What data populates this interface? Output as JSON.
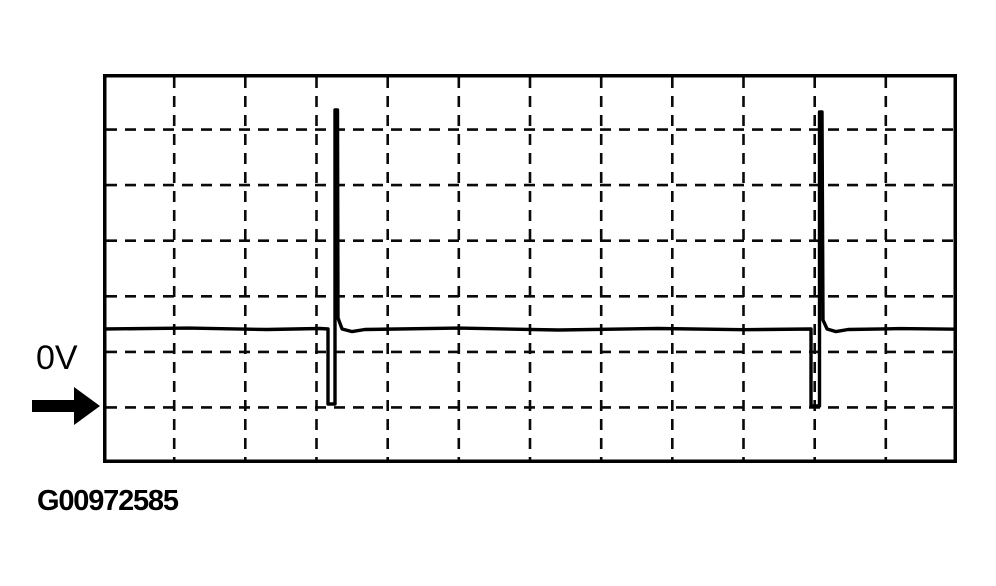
{
  "colors": {
    "background": "#ffffff",
    "trace": "#000000",
    "grid": "#0a0a0a",
    "border": "#000000",
    "text": "#000000"
  },
  "scope": {
    "zero_volt_label": "0V",
    "arrow_icon": "right-arrow pointing to 0V reference gridline"
  },
  "caption": {
    "figure_id": "G00972585"
  },
  "chart_data": {
    "type": "line",
    "title": "",
    "xlabel": "",
    "ylabel": "",
    "description": "Oscilloscope voltage waveform (scan-style figure). Flat baseline sits about 1.4 divisions above the 0V reference line. Two narrow dips drop to 0V (pulse on-time), each immediately followed by a tall narrow voltage spike reaching about 5.3 divisions above 0V, then the trace settles back to the baseline.",
    "grid": "dashed",
    "legend": "none",
    "x_divisions": 12,
    "y_divisions": 7,
    "zero_volt_line_y_div": 6,
    "baseline_y_div": 4.59,
    "spike_peak_y_div": 0.65,
    "dip_x_ranges_div": [
      [
        3.16,
        3.26
      ],
      [
        9.95,
        10.07
      ]
    ],
    "annotations": [
      {
        "text": "0V",
        "meaning": "zero-volt reference level at the 6th horizontal gridline from top"
      }
    ],
    "series": [
      {
        "name": "voltage-trace",
        "units": "grid divisions (x: 0-12 left to right, y: 0-7 top to bottom)",
        "points_div": [
          [
            0.0,
            4.588
          ],
          [
            1.2,
            4.572
          ],
          [
            2.3,
            4.598
          ],
          [
            3.05,
            4.579
          ],
          [
            3.162,
            4.588
          ],
          [
            3.162,
            5.938
          ],
          [
            3.26,
            5.938
          ],
          [
            3.26,
            0.648
          ],
          [
            3.295,
            0.648
          ],
          [
            3.302,
            4.391
          ],
          [
            3.36,
            4.588
          ],
          [
            3.5,
            4.636
          ],
          [
            3.68,
            4.597
          ],
          [
            5.0,
            4.572
          ],
          [
            6.4,
            4.606
          ],
          [
            7.8,
            4.579
          ],
          [
            9.0,
            4.601
          ],
          [
            9.949,
            4.588
          ],
          [
            9.949,
            5.974
          ],
          [
            10.068,
            5.974
          ],
          [
            10.068,
            0.684
          ],
          [
            10.103,
            0.684
          ],
          [
            10.117,
            4.427
          ],
          [
            10.175,
            4.588
          ],
          [
            10.3,
            4.636
          ],
          [
            10.47,
            4.597
          ],
          [
            11.2,
            4.581
          ],
          [
            12.0,
            4.592
          ]
        ]
      }
    ]
  }
}
